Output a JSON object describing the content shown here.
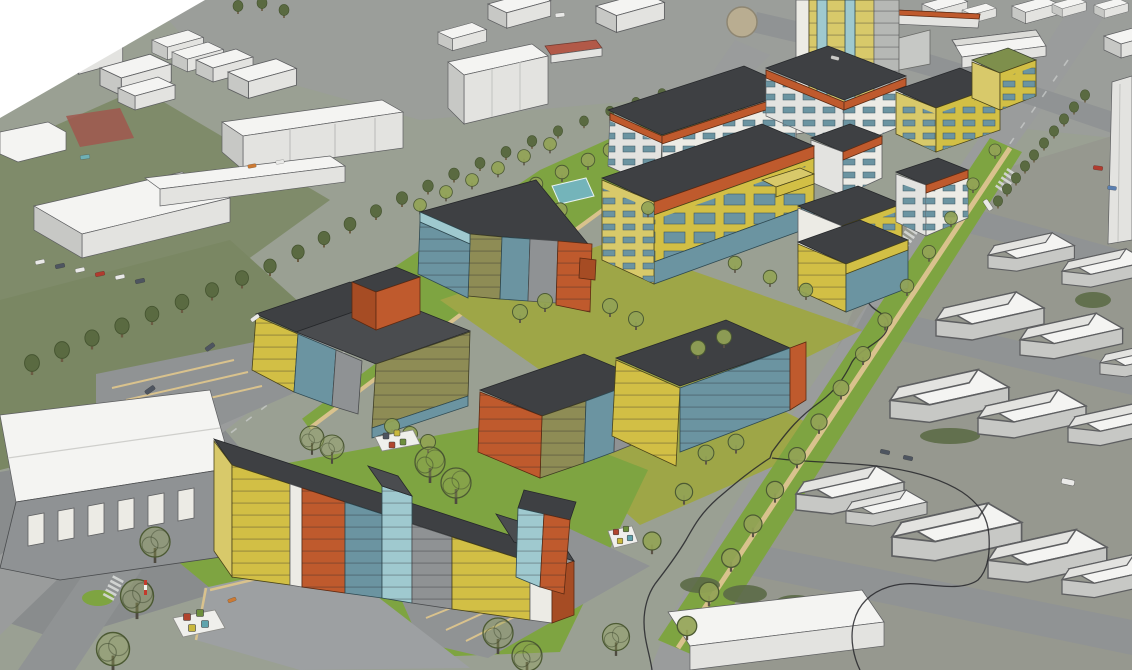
{
  "viewport": {
    "type": "3d-aerial-massing-view",
    "description": "Aerial 3D perspective of an urban site model: a proposed mixed-use development rendered with yellow, orange, olive and teal-glass facades and dark flat roofs, set on green landscaped parcels with stylized trees, surrounded by plain white context buildings on photographic aerial terrain with roads, parking lots and a tree-lined boulevard; a thin black site-boundary line meanders along the right side."
  },
  "palette": {
    "void": "#ffffff",
    "ground": "#9aa093",
    "ground2": "#898c8d",
    "grass_photo": "#7a8763",
    "grass_dark": "#5c6b47",
    "grass_dev": "#7ea441",
    "lawn": "#9ea647",
    "road": "#9a9c9c",
    "road2": "#909394",
    "lot": "#9da0a2",
    "white_top": "#f4f4f2",
    "white_face": "#e3e3e0",
    "white_side": "#c7c8c5",
    "white_trim": "#ecebe5",
    "line": "#5e5f61",
    "roof": "#3e4043",
    "roof2": "#4a4c4f",
    "green_roof": "#7e8f4c",
    "yellow": "#d2bf45",
    "yellow2": "#d8c96a",
    "olive": "#8e8c55",
    "orange": "#bf5a2d",
    "orange2": "#a64c24",
    "teal": "#6b94a1",
    "teal2": "#9fc9cf",
    "panel": "#8f9294",
    "red_roof": "#b25948",
    "red_patch": "#a0574d",
    "pool": "#74b4ba",
    "tree_photo": "#5a6a41",
    "tree_photo_dark": "#465531",
    "tree_dev": "#93a356",
    "tree_outline": "#4c5a33",
    "trunk": "#6b5c43",
    "bound": "#26262a",
    "path": "#d9c28d",
    "cube_red": "#b1442e",
    "cube_green": "#6d8f3d",
    "cube_yellow": "#c9b83e",
    "cube_teal": "#5fa3ad",
    "car_white": "#e9e9e7",
    "car_dark": "#4e5560",
    "car_red": "#b03b2e",
    "car_teal": "#6fb0b4",
    "car_orange": "#cc7a33"
  },
  "scene": {
    "development": {
      "name": "proposed-development",
      "buildings": [
        "high-rise-tower",
        "north-courtyard-block-west",
        "north-courtyard-block-east",
        "mixed-use-long-block",
        "yellow-midrise-a",
        "yellow-midrise-b",
        "white-teal-block-a",
        "white-teal-block-b",
        "courtyard-block-north",
        "courtyard-block-west",
        "courtyard-block-south",
        "courtyard-block-east",
        "boulevard-block",
        "foreground-bar-block",
        "foreground-small-block"
      ],
      "landscape": [
        "tree-lined-park",
        "courtyard-lawn",
        "south-lawn",
        "boulevard-verge",
        "water-feature",
        "utility-cube-markers"
      ]
    },
    "context": {
      "name": "existing-context",
      "features": [
        "white-massing-buildings",
        "industrial-gable-sheds",
        "warehouse-with-canopy",
        "arterial-road",
        "boulevard",
        "roundabout",
        "red-roof-building",
        "red-court-patch",
        "parking-lots",
        "avenue-trees",
        "site-boundary-line",
        "crosswalks",
        "cars"
      ]
    }
  }
}
